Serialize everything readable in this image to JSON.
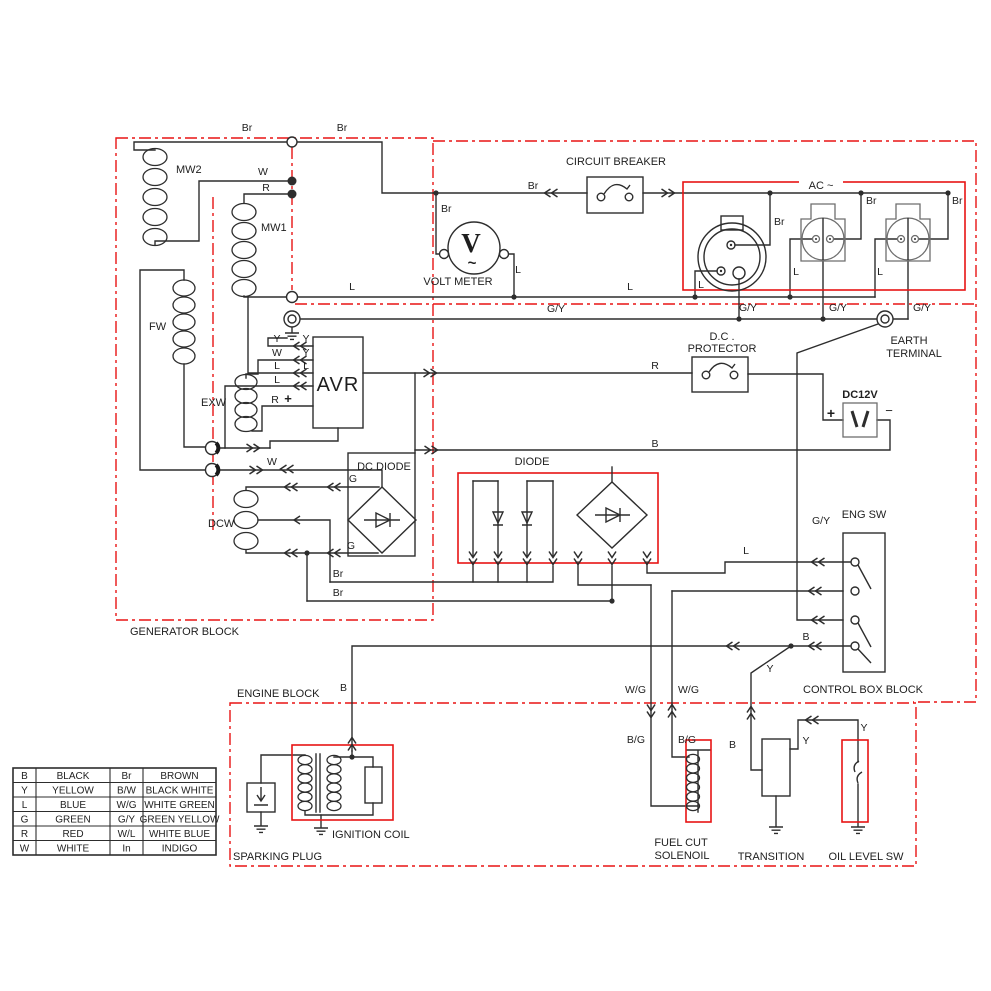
{
  "diagram": {
    "title": "generator-wiring-diagram",
    "colors": {
      "wire": "#2d2d2d",
      "wire_soft": "#6e6e6e",
      "highlight": "#e81414"
    },
    "labels": {
      "mw2": "MW2",
      "mw1": "MW1",
      "fw": "FW",
      "exw": "EXW",
      "dcw": "DCW",
      "avr": "AVR",
      "volt_v": "V",
      "volt_tilde": "~",
      "volt_meter": "VOLT METER",
      "circuit_breaker": "CIRCUIT BREAKER",
      "ac": "AC ~",
      "earth1": "EARTH",
      "earth2": "TERMINAL",
      "dcp1": "D.C .",
      "dcp2": "PROTECTOR",
      "dc12v": "DC12V",
      "dc_diode": "DC DIODE",
      "diode": "DIODE",
      "eng_sw": "ENG SW",
      "generator_block": "GENERATOR BLOCK",
      "engine_block": "ENGINE BLOCK",
      "control_block": "CONTROL BOX BLOCK",
      "sparking_plug": "SPARKING PLUG",
      "ignition_coil": "IGNITION COIL",
      "fuel_cut1": "FUEL CUT",
      "fuel_cut2": "SOLENOIL",
      "transition": "TRANSITION",
      "oil_level": "OIL LEVEL SW"
    },
    "wire_labels": [
      {
        "t": "Br",
        "x": 247,
        "y": 131
      },
      {
        "t": "Br",
        "x": 342,
        "y": 131
      },
      {
        "t": "Br",
        "x": 441,
        "y": 212,
        "a": "s"
      },
      {
        "t": "Br",
        "x": 533,
        "y": 189
      },
      {
        "t": "Br",
        "x": 774,
        "y": 225,
        "a": "s"
      },
      {
        "t": "Br",
        "x": 866,
        "y": 204,
        "a": "s"
      },
      {
        "t": "Br",
        "x": 952,
        "y": 204,
        "a": "s"
      },
      {
        "t": "W",
        "x": 263,
        "y": 175
      },
      {
        "t": "R",
        "x": 266,
        "y": 191
      },
      {
        "t": "L",
        "x": 352,
        "y": 290
      },
      {
        "t": "L",
        "x": 518,
        "y": 273
      },
      {
        "t": "L",
        "x": 630,
        "y": 290
      },
      {
        "t": "L",
        "x": 701,
        "y": 288
      },
      {
        "t": "L",
        "x": 796,
        "y": 275
      },
      {
        "t": "L",
        "x": 880,
        "y": 275
      },
      {
        "t": "L",
        "x": 746,
        "y": 554
      },
      {
        "t": "G/Y",
        "x": 556,
        "y": 312
      },
      {
        "t": "G/Y",
        "x": 748,
        "y": 311
      },
      {
        "t": "G/Y",
        "x": 838,
        "y": 311
      },
      {
        "t": "G/Y",
        "x": 922,
        "y": 311
      },
      {
        "t": "G/Y",
        "x": 812,
        "y": 524,
        "a": "s"
      },
      {
        "t": "Y",
        "x": 277,
        "y": 342
      },
      {
        "t": "Y",
        "x": 306,
        "y": 342
      },
      {
        "t": "W",
        "x": 277,
        "y": 356
      },
      {
        "t": "Y",
        "x": 306,
        "y": 356
      },
      {
        "t": "L",
        "x": 277,
        "y": 369
      },
      {
        "t": "L",
        "x": 306,
        "y": 369
      },
      {
        "t": "L",
        "x": 277,
        "y": 383
      },
      {
        "t": "R",
        "x": 275,
        "y": 403
      },
      {
        "t": "+",
        "x": 288,
        "y": 403,
        "b": 1,
        "fs": 13
      },
      {
        "t": "W",
        "x": 272,
        "y": 465
      },
      {
        "t": "G",
        "x": 353,
        "y": 482
      },
      {
        "t": "G",
        "x": 351,
        "y": 549
      },
      {
        "t": "Br",
        "x": 338,
        "y": 577
      },
      {
        "t": "Br",
        "x": 338,
        "y": 596
      },
      {
        "t": "R",
        "x": 655,
        "y": 369
      },
      {
        "t": "B",
        "x": 655,
        "y": 447
      },
      {
        "t": "B",
        "x": 347,
        "y": 691,
        "a": "e"
      },
      {
        "t": "W/G",
        "x": 646,
        "y": 693,
        "a": "e"
      },
      {
        "t": "W/G",
        "x": 678,
        "y": 693,
        "a": "s"
      },
      {
        "t": "B/G",
        "x": 645,
        "y": 743,
        "a": "e"
      },
      {
        "t": "B/G",
        "x": 678,
        "y": 743,
        "a": "s"
      },
      {
        "t": "B",
        "x": 806,
        "y": 640
      },
      {
        "t": "Y",
        "x": 770,
        "y": 672
      },
      {
        "t": "B",
        "x": 736,
        "y": 748,
        "a": "e"
      },
      {
        "t": "Y",
        "x": 806,
        "y": 744
      },
      {
        "t": "Y",
        "x": 864,
        "y": 731
      },
      {
        "t": "+",
        "x": 831,
        "y": 418,
        "b": 1,
        "fs": 14
      },
      {
        "t": "−",
        "x": 889,
        "y": 415,
        "fs": 13
      }
    ],
    "legend": {
      "rows": [
        [
          "B",
          "BLACK",
          "Br",
          "BROWN"
        ],
        [
          "Y",
          "YELLOW",
          "B/W",
          "BLACK WHITE"
        ],
        [
          "L",
          "BLUE",
          "W/G",
          "WHITE GREEN"
        ],
        [
          "G",
          "GREEN",
          "G/Y",
          "GREEN YELLOW"
        ],
        [
          "R",
          "RED",
          "W/L",
          "WHITE BLUE"
        ],
        [
          "W",
          "WHITE",
          "In",
          "INDIGO"
        ]
      ]
    }
  }
}
